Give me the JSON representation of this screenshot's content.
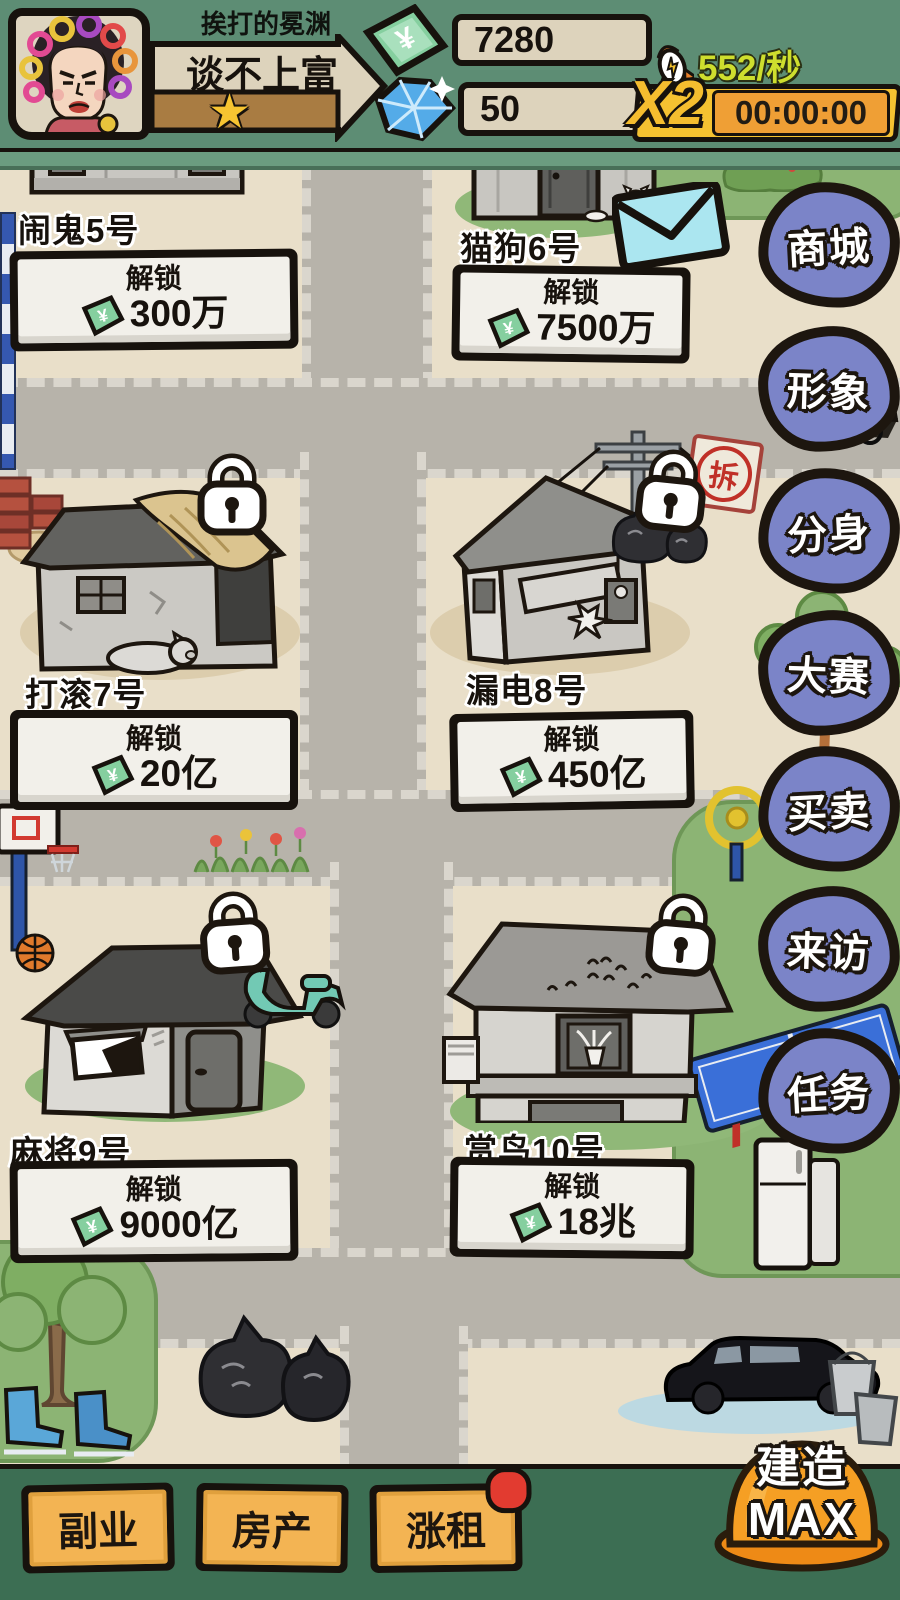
{
  "header": {
    "player_name": "挨打的冕渊",
    "wealth_title": "谈不上富",
    "star": "★",
    "money": "7280",
    "diamonds": "50",
    "income_rate": "552/秒",
    "multiplier": "X2",
    "boost_timer": "00:00:00"
  },
  "ui": {
    "unlock_label": "解锁"
  },
  "properties": [
    {
      "name": "闹鬼5号",
      "price": "300万"
    },
    {
      "name": "猫狗6号",
      "price": "7500万"
    },
    {
      "name": "打滚7号",
      "price": "20亿"
    },
    {
      "name": "漏电8号",
      "price": "450亿"
    },
    {
      "name": "麻将9号",
      "price": "9000亿"
    },
    {
      "name": "赏鸟10号",
      "price": "18兆"
    }
  ],
  "sidebar": {
    "items": [
      {
        "label": "商城"
      },
      {
        "label": "形象"
      },
      {
        "label": "分身"
      },
      {
        "label": "大赛"
      },
      {
        "label": "买卖"
      },
      {
        "label": "来访"
      },
      {
        "label": "任务"
      }
    ]
  },
  "bottom_bar": {
    "buttons": [
      {
        "label": "副业"
      },
      {
        "label": "房产"
      },
      {
        "label": "涨租",
        "badge": true
      }
    ],
    "build_button": {
      "line1": "建造",
      "line2": "MAX"
    }
  },
  "map": {
    "demolish_sign": "拆"
  },
  "colors": {
    "top_bar_green": "#5d8d74",
    "panel_beige": "#ddd3bc",
    "money_green": "#85cf9f",
    "diamond_blue": "#54abe8",
    "sidebar_purple": "#7b84c8",
    "action_orange": "#f3b453",
    "boost_yellow": "#f5c231",
    "rate_yellow_green": "#cede2e",
    "badge_red": "#e23b30"
  }
}
